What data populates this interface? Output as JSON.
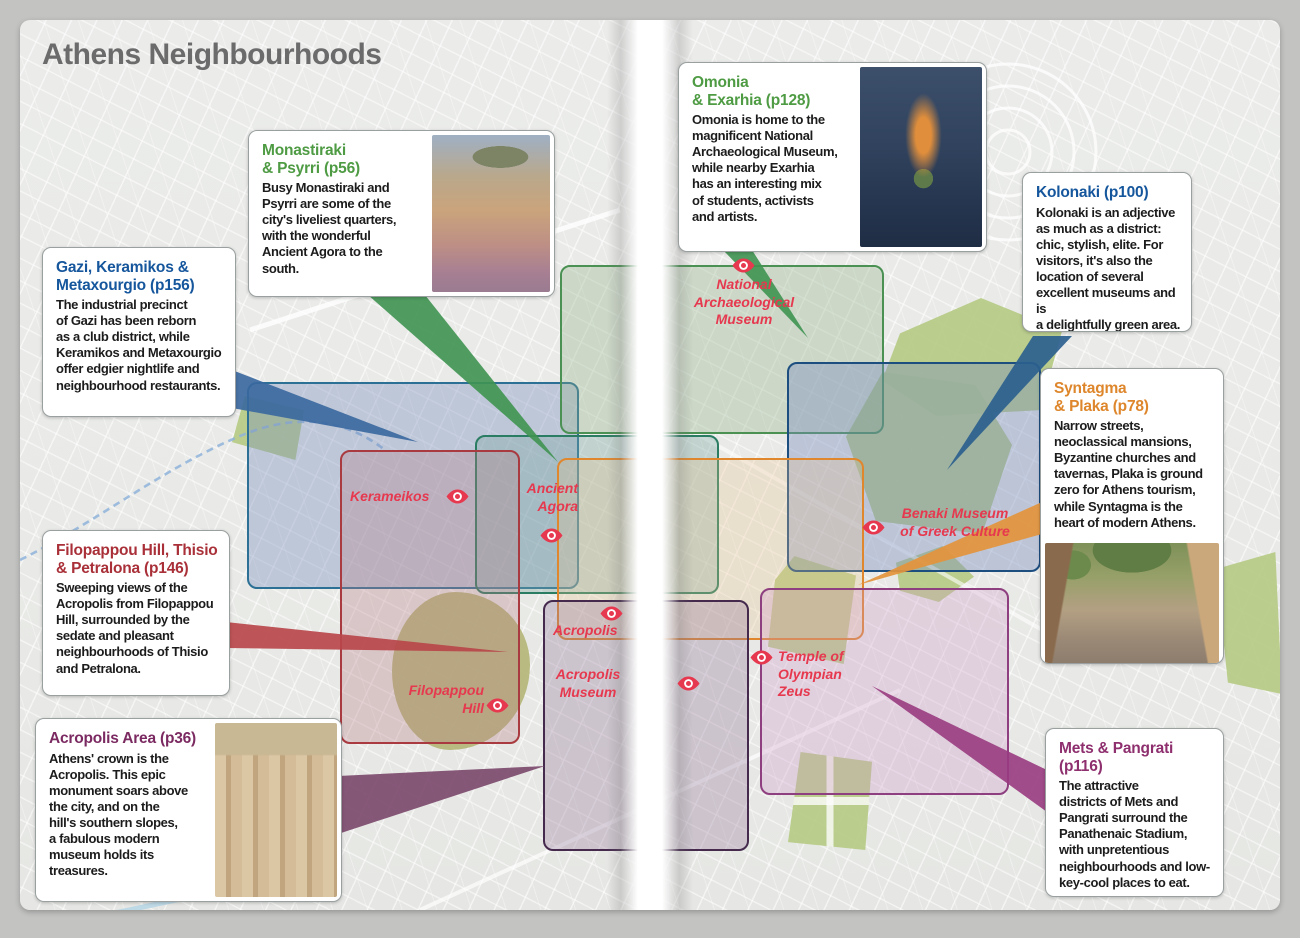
{
  "page": {
    "title": "Athens Neighbourhoods"
  },
  "callouts": {
    "monastiraki": {
      "heading": "Monastiraki\n& Psyrri (p56)",
      "body": "Busy Monastiraki and\nPsyrri are some of the\ncity's liveliest quarters,\nwith the wonderful\nAncient Agora to the\nsouth.",
      "accent": "#4e9b43",
      "photo": "aerial view of Monastiraki square at dusk with Acropolis hill"
    },
    "omonia": {
      "heading": "Omonia\n& Exarhia (p128)",
      "body": "Omonia is home to the\nmagnificent National\nArchaeological Museum,\nwhile nearby Exarhia\nhas an interesting mix\nof students, activists\nand artists.",
      "accent": "#4e9b43",
      "photo": "night aerial view of Omonia square"
    },
    "kolonaki": {
      "heading": "Kolonaki (p100)",
      "body": "Kolonaki is an adjective\nas much as a district:\nchic, stylish, elite. For\nvisitors, it's also the\nlocation of several\nexcellent museums and is\na delightfully green area.",
      "accent": "#15569c"
    },
    "gazi": {
      "heading": "Gazi, Keramikos &\nMetaxourgio (p156)",
      "body": "The industrial precinct\nof Gazi has been reborn\nas a club district, while\nKeramikos and Metaxourgio\noffer edgier nightlife and\nneighbourhood restaurants.",
      "accent": "#15569c"
    },
    "syntagma": {
      "heading": "Syntagma\n& Plaka (p78)",
      "body": "Narrow streets,\nneoclassical mansions,\nByzantine churches and\ntavernas, Plaka is ground\nzero for Athens tourism,\nwhile Syntagma is the\nheart of modern Athens.",
      "accent": "#de862b",
      "photo": "Plaka street with trees and taverna tables"
    },
    "filopappou": {
      "heading": "Filopappou Hill, Thisio\n& Petralona (p146)",
      "body": "Sweeping views of the\nAcropolis from Filopappou\nHill, surrounded by the\nsedate and pleasant\nneighbourhoods of Thisio\nand Petralona.",
      "accent": "#a93038"
    },
    "acropolis": {
      "heading": "Acropolis Area (p36)",
      "body": "Athens' crown is the\nAcropolis. This epic\nmonument soars above\nthe city, and on the\nhill's southern slopes,\na fabulous modern\nmuseum holds its\ntreasures.",
      "accent": "#7b2a61",
      "photo": "Caryatid statues of the Erechtheion against blue sky"
    },
    "mets": {
      "heading": "Mets & Pangrati (p116)",
      "body": "The attractive\ndistricts of Mets and\nPangrati surround the\nPanathenaic Stadium,\nwith unpretentious\nneighbourhoods and low-\nkey-cool places to eat.",
      "accent": "#8e2f6e"
    }
  },
  "map": {
    "labels": {
      "national_archaeological_museum": "National\nArchaeological\nMuseum",
      "kerameikos": "Kerameikos",
      "ancient_agora": "Ancient\nAgora",
      "benaki": "Benaki Museum\nof Greek Culture",
      "acropolis": "Acropolis",
      "acropolis_museum": "Acropolis\nMuseum",
      "filopappou_hill": "Filopappou\nHill",
      "temple_of_olympian_zeus": "Temple of\nOlympian\nZeus"
    },
    "label_color": "#e6384e",
    "sight_icon_color": "#e6384e",
    "regions": [
      {
        "id": "gazi-keramikos-metaxourgio",
        "border": "#2d7096"
      },
      {
        "id": "monastiraki-psyrri",
        "border": "#2a7d62"
      },
      {
        "id": "omonia-exarhia",
        "border": "#4a9153"
      },
      {
        "id": "kolonaki",
        "border": "#1d4e80"
      },
      {
        "id": "syntagma-plaka",
        "border": "#e0872e"
      },
      {
        "id": "filopappou-thisio-petralona",
        "border": "#a83a40"
      },
      {
        "id": "acropolis-area",
        "border": "#452a4e"
      },
      {
        "id": "mets-pangrati",
        "border": "#8e3f80"
      }
    ]
  }
}
